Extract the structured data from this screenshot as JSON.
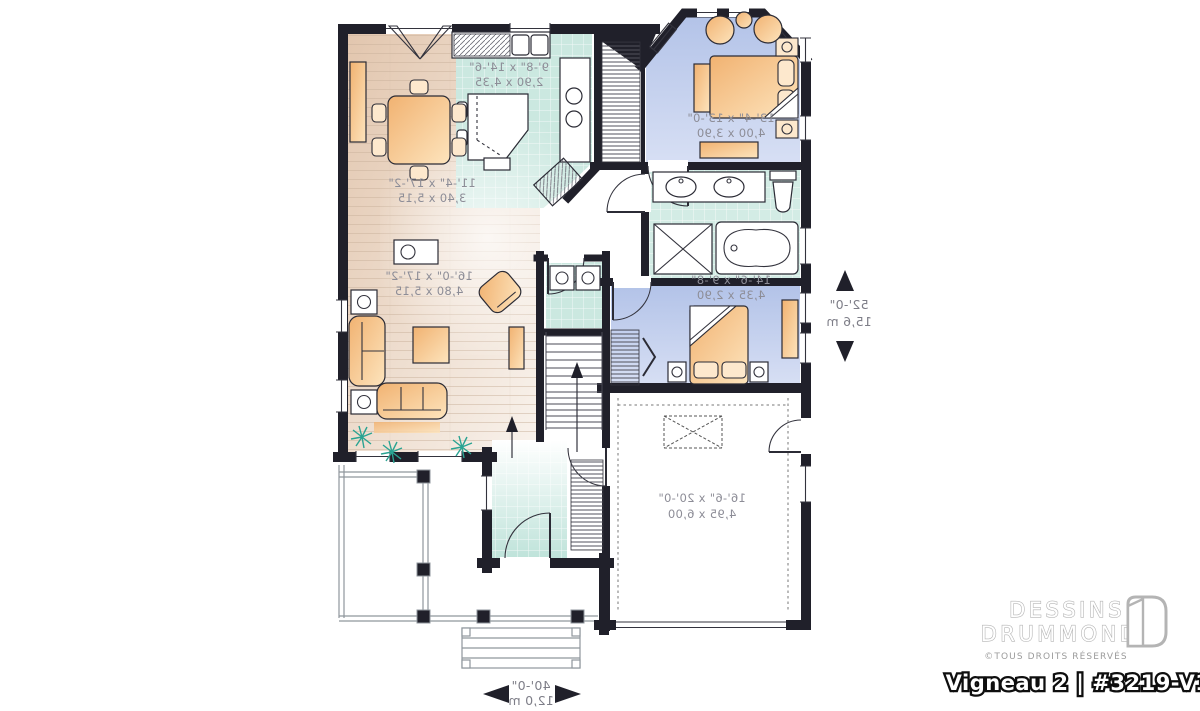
{
  "brand": {
    "line1": "DESSINS",
    "line2": "DRUMMOND",
    "copyright": "©TOUS DROITS RÉSERVÉS",
    "model": "Vigneau 2 | #3219-V1"
  },
  "overall_dimensions": {
    "width_imperial": "40'-0\"",
    "width_metric": "12,0 m",
    "depth_imperial": "52'-0\"",
    "depth_metric": "15,6 m"
  },
  "rooms": {
    "dining": {
      "imperial": "11'-4\" x 17'-2\"",
      "metric": "3,40 x 5,15"
    },
    "kitchen": {
      "imperial": "9'-8\" x 14'-6\"",
      "metric": "2,90 x 4,35"
    },
    "master": {
      "imperial": "13'-4\" x 13'-0\"",
      "metric": "4,00 x 3,90"
    },
    "living": {
      "imperial": "16'-0\" x 17'-2\"",
      "metric": "4,80 x 5,15"
    },
    "bedroom2": {
      "imperial": "14'-6\" x 9'-8\"",
      "metric": "4,35 x 2,90"
    },
    "garage": {
      "imperial": "16'-6\" x 20'-0\"",
      "metric": "4,95 x 6,00"
    }
  },
  "notes": {
    "text_mirrored": "plan text appears mirror-imaged (reversed plan)"
  },
  "colors": {
    "wall": "#20202a",
    "wood_floor": "#e2c6ae",
    "tile": "#cbe8e0",
    "bedroom_blue": "#b3c3e8",
    "furniture_orange": "#f1b271",
    "plant_green": "#2aa392",
    "logo_gray": "#b4b4b4"
  }
}
